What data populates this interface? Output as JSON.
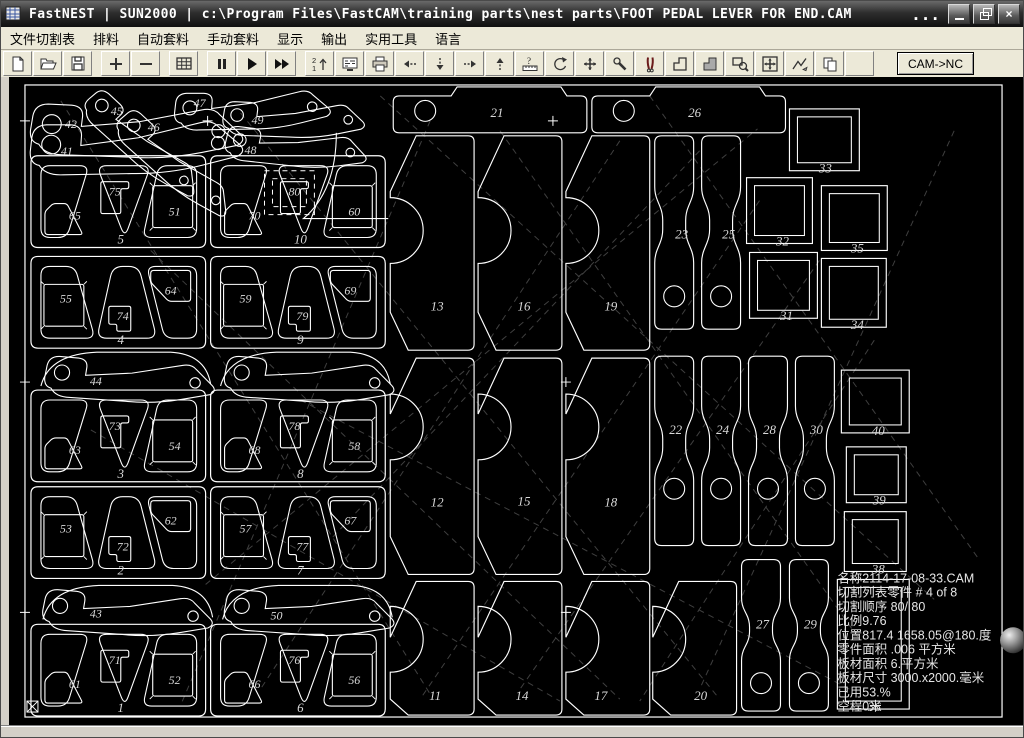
{
  "window": {
    "title": "FastNEST   |   SUN2000   |   c:\\Program Files\\FastCAM\\training parts\\nest parts\\FOOT PEDAL LEVER FOR END.CAM",
    "overflow": "...",
    "controls": {
      "minimize": "minimize",
      "restore": "restore",
      "close": "close",
      "close_glyph": "×"
    }
  },
  "menu": {
    "items": [
      "文件切割表",
      "排料",
      "自动套料",
      "手动套料",
      "显示",
      "输出",
      "实用工具",
      "语言"
    ]
  },
  "toolbar": {
    "buttons": [
      {
        "name": "new-file"
      },
      {
        "name": "open-file"
      },
      {
        "name": "save"
      },
      {
        "name": "zoom-in",
        "gap": true
      },
      {
        "name": "zoom-out"
      },
      {
        "name": "sheet-grid",
        "gap": true
      },
      {
        "name": "pause",
        "gap": true
      },
      {
        "name": "start-nest"
      },
      {
        "name": "fast-nest"
      },
      {
        "name": "sequence",
        "gap": true
      },
      {
        "name": "nc-code"
      },
      {
        "name": "print"
      },
      {
        "name": "move-left"
      },
      {
        "name": "move-down"
      },
      {
        "name": "move-right"
      },
      {
        "name": "move-up"
      },
      {
        "name": "measure"
      },
      {
        "name": "rotate"
      },
      {
        "name": "align"
      },
      {
        "name": "settings"
      },
      {
        "name": "cut"
      },
      {
        "name": "corner-loop"
      },
      {
        "name": "corner-loop-filled"
      },
      {
        "name": "zoom-window"
      },
      {
        "name": "fit-view"
      },
      {
        "name": "profile"
      },
      {
        "name": "copy-sheet"
      },
      {
        "name": "blank"
      }
    ],
    "cam_nc_label": "CAM->NC"
  },
  "colors": {
    "outline": "#ffffff",
    "label": "#d9d9d9",
    "dash": "#3f3f3f",
    "info_text": "#e6e6e6",
    "canvas_bg": "#000000",
    "chrome_bg": "#ece9d8"
  },
  "nest": {
    "sheet": {
      "x": 24,
      "y": 84,
      "w": 979,
      "h": 634
    },
    "info": {
      "x": 838,
      "y": 583,
      "line_height": 14.3,
      "lines": [
        "名称2114-17-08-33.CAM",
        "切割列表零件  # 4 of 8",
        "切割顺序 80/ 80",
        "比例9.76",
        "位置817.4 1658.05@180.度",
        "零件面积  .006 平方米",
        "板材面积 6.平方米",
        "板材尺寸  3000.x2000.毫米",
        "已用53.%",
        "空程0米"
      ]
    },
    "plates": [
      {
        "no": "5",
        "x": 30,
        "y": 155,
        "variant": "A",
        "left": "65",
        "center": "75",
        "right": "51"
      },
      {
        "no": "10",
        "x": 210,
        "y": 155,
        "variant": "A",
        "left": "70",
        "center": "80",
        "right": "60",
        "selected_center": true
      },
      {
        "no": "4",
        "x": 30,
        "y": 256,
        "variant": "B",
        "left": "55",
        "center": "74",
        "right": "64"
      },
      {
        "no": "9",
        "x": 210,
        "y": 256,
        "variant": "B",
        "left": "59",
        "center": "79",
        "right": "69"
      },
      {
        "no": "3",
        "x": 30,
        "y": 390,
        "variant": "A",
        "left": "63",
        "center": "73",
        "right": "54"
      },
      {
        "no": "8",
        "x": 210,
        "y": 390,
        "variant": "A",
        "left": "68",
        "center": "78",
        "right": "58"
      },
      {
        "no": "2",
        "x": 30,
        "y": 487,
        "variant": "B",
        "left": "53",
        "center": "72",
        "right": "62"
      },
      {
        "no": "7",
        "x": 210,
        "y": 487,
        "variant": "B",
        "left": "57",
        "center": "77",
        "right": "67"
      },
      {
        "no": "1",
        "x": 30,
        "y": 625,
        "variant": "A",
        "left": "61",
        "center": "71",
        "right": "52"
      },
      {
        "no": "6",
        "x": 210,
        "y": 625,
        "variant": "A",
        "left": "66",
        "center": "76",
        "right": "56"
      }
    ],
    "tall_parts": [
      {
        "no": "13",
        "x": 390,
        "y": 135,
        "h": 215,
        "notch": 230,
        "label": [
          437,
          310
        ]
      },
      {
        "no": "16",
        "x": 478,
        "y": 135,
        "h": 215,
        "notch": 230,
        "label": [
          524,
          310
        ]
      },
      {
        "no": "19",
        "x": 566,
        "y": 135,
        "h": 215,
        "notch": 230,
        "label": [
          611,
          310
        ]
      },
      {
        "no": "12",
        "x": 390,
        "y": 358,
        "h": 217,
        "notch": 427,
        "label": [
          437,
          507
        ]
      },
      {
        "no": "15",
        "x": 478,
        "y": 358,
        "h": 217,
        "notch": 427,
        "label": [
          524,
          506
        ]
      },
      {
        "no": "18",
        "x": 566,
        "y": 358,
        "h": 217,
        "notch": 427,
        "label": [
          611,
          507
        ]
      },
      {
        "no": "11",
        "x": 390,
        "y": 582,
        "h": 134,
        "notch": 640,
        "label": [
          435,
          701
        ]
      },
      {
        "no": "14",
        "x": 478,
        "y": 582,
        "h": 134,
        "notch": 640,
        "label": [
          522,
          701
        ]
      },
      {
        "no": "17",
        "x": 566,
        "y": 582,
        "h": 134,
        "notch": 640,
        "label": [
          601,
          701
        ]
      },
      {
        "no": "20",
        "x": 653,
        "y": 582,
        "h": 134,
        "notch": 640,
        "label": [
          701,
          701
        ]
      }
    ],
    "bars": [
      {
        "no": "21",
        "x": 393,
        "y": 86,
        "hole": [
          425,
          110
        ],
        "label": [
          497,
          116
        ]
      },
      {
        "no": "26",
        "x": 592,
        "y": 86,
        "hole": [
          624,
          110
        ],
        "label": [
          695,
          116
        ]
      }
    ],
    "strips": [
      {
        "no": "23",
        "x": 653,
        "y": 135,
        "h": 194,
        "hole_y": 296,
        "label": [
          682,
          238
        ]
      },
      {
        "no": "25",
        "x": 700,
        "y": 135,
        "h": 194,
        "hole_y": 296,
        "label": [
          729,
          238
        ]
      },
      {
        "no": "22",
        "x": 653,
        "y": 356,
        "h": 190,
        "hole_y": 489,
        "label": [
          676,
          434
        ]
      },
      {
        "no": "24",
        "x": 700,
        "y": 356,
        "h": 190,
        "hole_y": 489,
        "label": [
          723,
          434
        ]
      },
      {
        "no": "28",
        "x": 747,
        "y": 356,
        "h": 190,
        "hole_y": 489,
        "label": [
          770,
          434
        ]
      },
      {
        "no": "30",
        "x": 794,
        "y": 356,
        "h": 190,
        "hole_y": 489,
        "label": [
          817,
          434
        ]
      },
      {
        "no": "27",
        "x": 740,
        "y": 560,
        "h": 152,
        "hole_y": 684,
        "label": [
          763,
          629
        ]
      },
      {
        "no": "29",
        "x": 788,
        "y": 560,
        "h": 152,
        "hole_y": 684,
        "label": [
          811,
          629
        ]
      }
    ],
    "squares": [
      {
        "no": "33",
        "x": 790,
        "y": 108,
        "w": 70,
        "h": 62,
        "label": [
          826,
          172
        ]
      },
      {
        "no": "32",
        "x": 747,
        "y": 177,
        "w": 66,
        "h": 66,
        "label": [
          783,
          245
        ]
      },
      {
        "no": "35",
        "x": 822,
        "y": 185,
        "w": 66,
        "h": 65,
        "label": [
          858,
          252
        ]
      },
      {
        "no": "31",
        "x": 750,
        "y": 252,
        "w": 68,
        "h": 66,
        "label": [
          787,
          320
        ]
      },
      {
        "no": "34",
        "x": 822,
        "y": 258,
        "w": 65,
        "h": 69,
        "label": [
          858,
          329
        ]
      },
      {
        "no": "40",
        "x": 842,
        "y": 370,
        "w": 68,
        "h": 63,
        "label": [
          879,
          435
        ]
      },
      {
        "no": "39",
        "x": 847,
        "y": 447,
        "w": 60,
        "h": 56,
        "label": [
          880,
          505
        ]
      },
      {
        "no": "38",
        "x": 845,
        "y": 512,
        "w": 62,
        "h": 60,
        "label": [
          879,
          574
        ]
      },
      {
        "no": "36",
        "x": 838,
        "y": 580,
        "w": 72,
        "h": 130,
        "label": [
          875,
          712
        ]
      }
    ],
    "levers": [
      {
        "no": "42",
        "x": 26,
        "y": 96,
        "w": 225,
        "rot": 0,
        "label": [
          70,
          127
        ]
      },
      {
        "no": "41",
        "x": 24,
        "y": 118,
        "w": 225,
        "rot": -3,
        "label": [
          66,
          154
        ]
      },
      {
        "no": "45",
        "x": 100,
        "y": 80,
        "w": 150,
        "rot": 40,
        "label": [
          116,
          114
        ]
      },
      {
        "no": "46",
        "x": 132,
        "y": 100,
        "w": 150,
        "rot": 40,
        "label": [
          153,
          130
        ]
      },
      {
        "no": "47",
        "x": 170,
        "y": 88,
        "w": 165,
        "rot": -3,
        "label": [
          199,
          106
        ]
      },
      {
        "no": "49",
        "x": 220,
        "y": 96,
        "w": 150,
        "rot": 0,
        "label": [
          257,
          123
        ]
      },
      {
        "no": "48",
        "x": 224,
        "y": 120,
        "w": 150,
        "rot": 4,
        "label": [
          250,
          153
        ]
      },
      {
        "no": "44",
        "x": 42,
        "y": 350,
        "w": 180,
        "rot": 2,
        "label": [
          95,
          385
        ]
      },
      {
        "no": "",
        "x": 222,
        "y": 350,
        "w": 180,
        "rot": 2,
        "label": null
      },
      {
        "no": "43",
        "x": 40,
        "y": 584,
        "w": 180,
        "rot": 2,
        "label": [
          95,
          618
        ]
      },
      {
        "no": "50",
        "x": 222,
        "y": 584,
        "w": 180,
        "rot": 2,
        "label": [
          276,
          620
        ]
      }
    ],
    "arcs": [
      "M336,132 Q336,190 303,218 L388,218",
      "M40,386 Q48,354 96,352 L170,352 Q205,354 210,384",
      "M220,386 Q228,354 276,352 L350,352 Q385,354 390,384",
      "M42,620 Q50,588 98,586 L172,586 Q207,588 212,618",
      "M222,620 Q230,588 278,586 L352,586 Q387,588 392,618"
    ],
    "dashes": [
      [
        60,
        100,
        430,
        695
      ],
      [
        240,
        112,
        720,
        700
      ],
      [
        430,
        120,
        180,
        706
      ],
      [
        620,
        140,
        260,
        690
      ],
      [
        700,
        150,
        330,
        540
      ],
      [
        760,
        200,
        420,
        700
      ],
      [
        820,
        260,
        520,
        690
      ],
      [
        500,
        130,
        860,
        640
      ],
      [
        380,
        95,
        935,
        600
      ],
      [
        150,
        250,
        620,
        700
      ],
      [
        875,
        340,
        640,
        702
      ],
      [
        300,
        400,
        850,
        690
      ],
      [
        90,
        430,
        560,
        702
      ],
      [
        955,
        130,
        700,
        690
      ],
      [
        205,
        585,
        758,
        128
      ],
      [
        650,
        95,
        980,
        560
      ]
    ],
    "crosses": [
      [
        24,
        120
      ],
      [
        24,
        382
      ],
      [
        24,
        613
      ],
      [
        553,
        120
      ],
      [
        566,
        382
      ],
      [
        566,
        613
      ],
      [
        207,
        120
      ]
    ],
    "selection": {
      "part": "80",
      "rects": [
        [
          264,
          170,
          50,
          44
        ],
        [
          272,
          178,
          34,
          28
        ]
      ]
    },
    "origin_marker": {
      "x": 26,
      "y": 702,
      "size": 11
    },
    "sphere": {
      "cx": 1014,
      "cy": 641,
      "r": 13
    }
  }
}
